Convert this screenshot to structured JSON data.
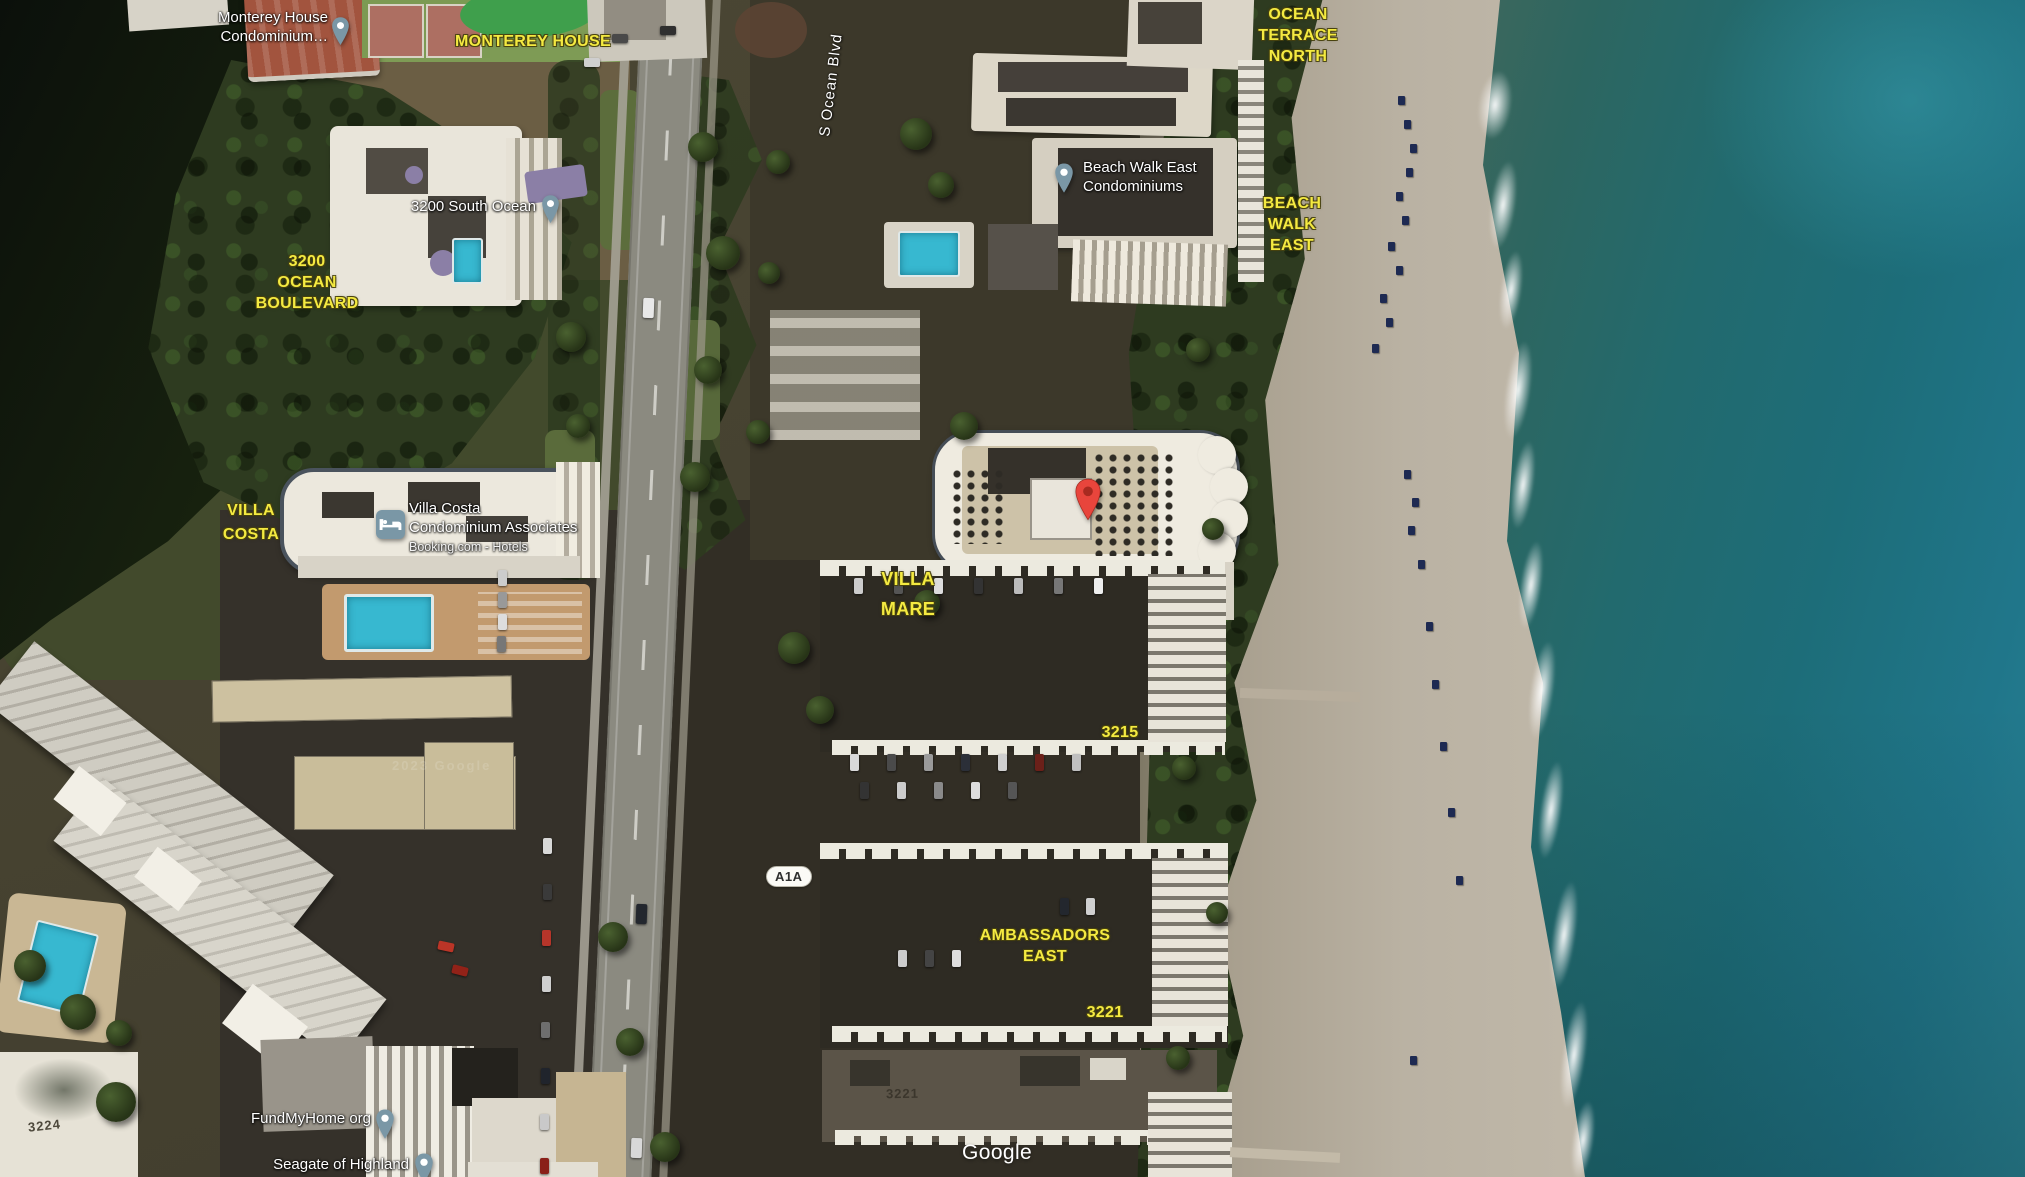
{
  "road": {
    "street_name": "S Ocean Blvd",
    "route_shield": "A1A"
  },
  "area_labels": {
    "monterey_house": "MONTEREY HOUSE",
    "ocean_terrace_north": "OCEAN\nTERRACE\nNORTH",
    "ocean_boulevard_3200": "3200\nOCEAN\nBOULEVARD",
    "beach_walk_east": "BEACH\nWALK\nEAST",
    "villa_costa": "VILLA\nCOSTA",
    "villa_mare": "VILLA\nMARE",
    "building_3215": "3215",
    "ambassadors_east": "AMBASSADORS\nEAST",
    "building_3221": "3221"
  },
  "poi_labels": {
    "monterey_house_condominium": "Monterey House\nCondominium…",
    "south_ocean_3200": "3200 South Ocean",
    "beach_walk_east_condominiums": "Beach Walk East\nCondominiums",
    "villa_costa_condominium": "Villa Costa\nCondominium Associates",
    "villa_costa_subtitle": "Booking.com - Hotels",
    "fundmyhome": "FundMyHome org",
    "seagate_of_highland": "Seagate of Highland"
  },
  "imagery_text": {
    "rooftop_3221": "3221",
    "rooftop_3224": "3224",
    "imagery_watermark": "2023 Google"
  },
  "attribution": {
    "brand": "Google"
  },
  "icons": {
    "poi_pin": "map-pin",
    "destination_pin": "red-map-pin",
    "lodging": "bed-icon"
  },
  "colors": {
    "label_yellow": "#f4ea41",
    "poi_pin_fill": "#7a97a6",
    "destination_pin_fill": "#e8453c",
    "pool_water": "#37b8d0",
    "ocean": "#1d6d79"
  }
}
